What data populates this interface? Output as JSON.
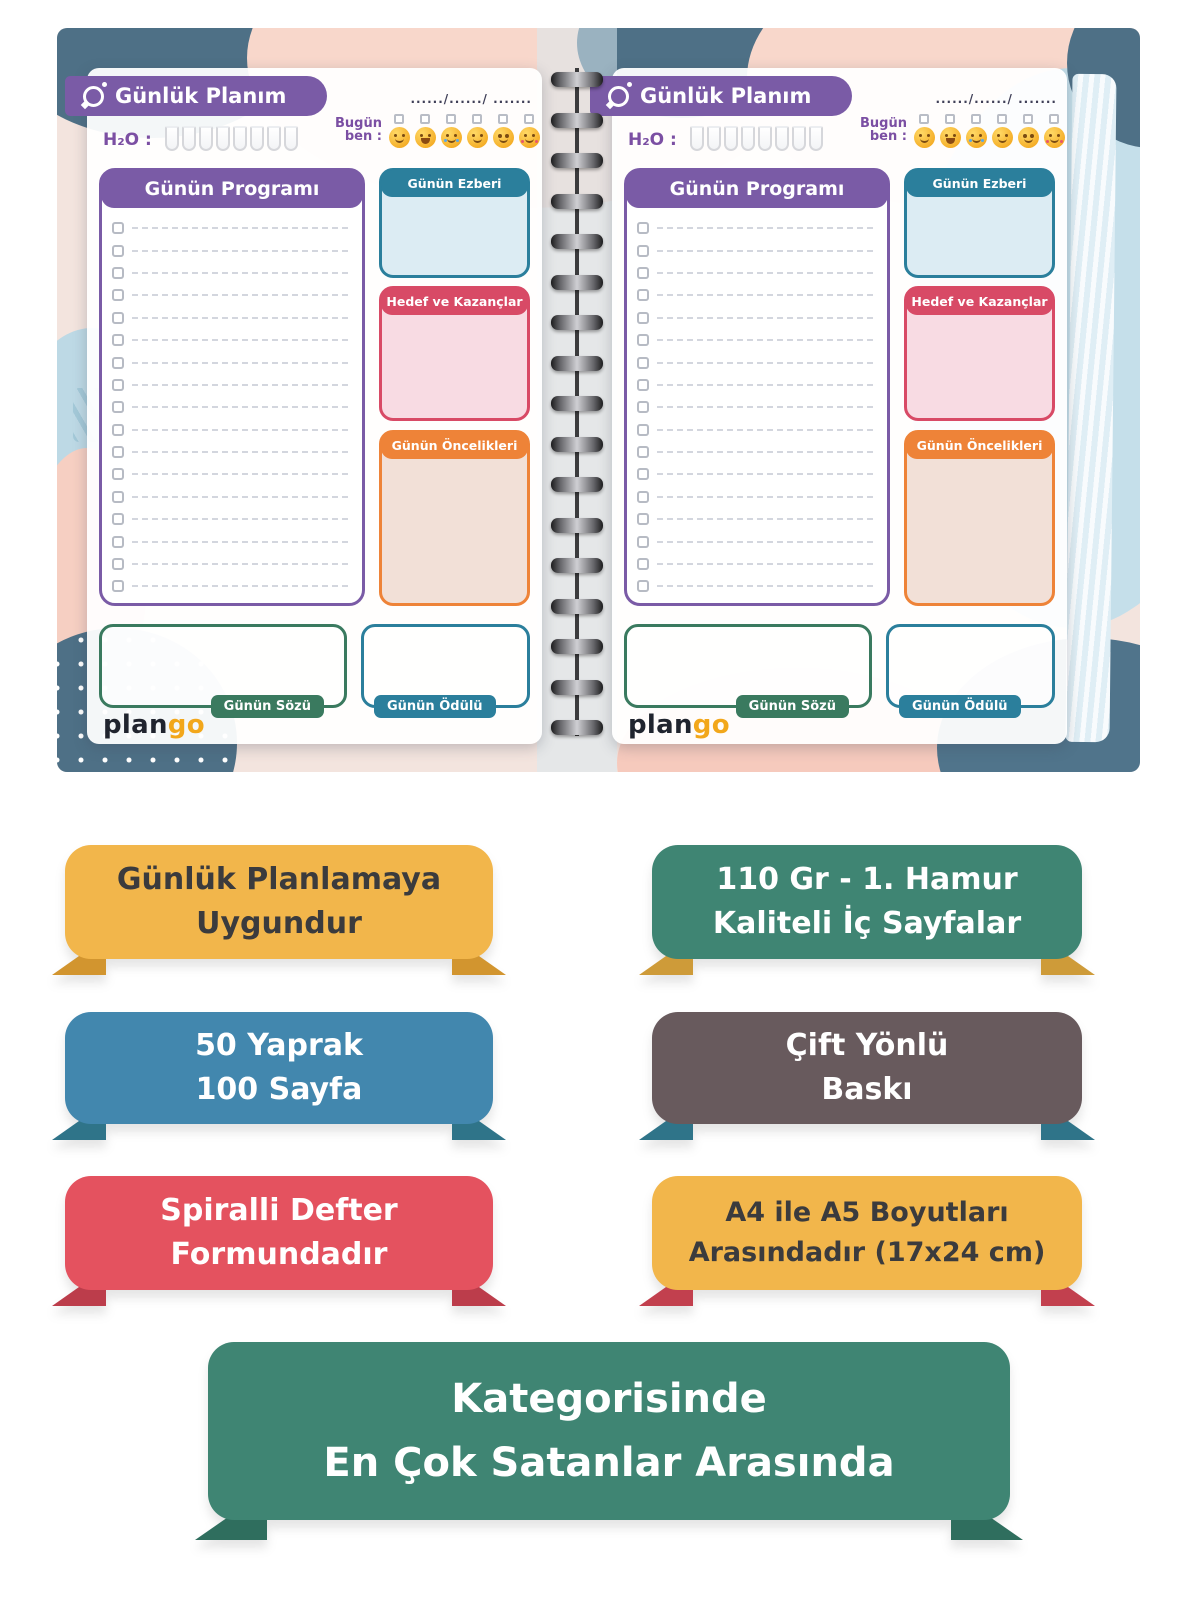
{
  "cover": {
    "page": {
      "header": {
        "title": "Günlük Planım",
        "date_dots": "....../....../ ......."
      },
      "water": {
        "label": "H₂O :",
        "cups": 8
      },
      "mood": {
        "label_line1": "Bugün",
        "label_line2": "ben :",
        "faces": [
          "smiling",
          "laughing",
          "crying",
          "smiling",
          "pleading",
          "hearts"
        ]
      },
      "sections": {
        "program_title": "Günün Programı",
        "program_rows": 17,
        "memorize_title": "Günün Ezberi",
        "goals_title": "Hedef ve Kazançlar",
        "priorities_title": "Günün Öncelikleri",
        "quote_label": "Günün Sözü",
        "reward_label": "Günün Ödülü"
      },
      "logo": {
        "part1": "plan",
        "part2": "go"
      }
    },
    "spiral_coils": 17,
    "colors": {
      "banner_purple": "#7A5BA6",
      "memorize_teal": "#2B7F9C",
      "goals_red": "#D84A66",
      "priorities_orange": "#EE8338",
      "quote_green": "#3A7A5F",
      "logo_orange": "#F2A71B"
    }
  },
  "badges": [
    {
      "name": "daily-planning",
      "line1": "Günlük Planlamaya",
      "line2": "Uygundur",
      "bg": "#F2B64B",
      "fg": "#3B3B3D",
      "fold": "#D2952F"
    },
    {
      "name": "paper-quality",
      "line1": "110 Gr - 1. Hamur",
      "line2": "Kaliteli İç Sayfalar",
      "bg": "#3F8573",
      "fg": "#FFFFFF",
      "fold": "#CE9B39"
    },
    {
      "name": "page-count",
      "line1": "50 Yaprak",
      "line2": "100 Sayfa",
      "bg": "#4287AE",
      "fg": "#FFFFFF",
      "fold": "#2F7489"
    },
    {
      "name": "double-sided",
      "line1": "Çift Yönlü",
      "line2": "Baskı",
      "bg": "#685A5D",
      "fg": "#FFFFFF",
      "fold": "#2F7489"
    },
    {
      "name": "spiral-form",
      "line1": "Spiralli Defter",
      "line2": "Formundadır",
      "bg": "#E4525F",
      "fg": "#FFFFFF",
      "fold": "#BC3D4B"
    },
    {
      "name": "size-17x24",
      "line1": "A4 ile A5 Boyutları",
      "line2": "Arasındadır (17x24 cm)",
      "bg": "#F2B64B",
      "fg": "#3B3B3D",
      "fold": "#C2404E"
    },
    {
      "name": "bestseller",
      "line1": "Kategorisinde",
      "line2": "En Çok Satanlar Arasında",
      "bg": "#3F8573",
      "fg": "#FFFFFF",
      "fold": "#2F6E5E"
    }
  ]
}
